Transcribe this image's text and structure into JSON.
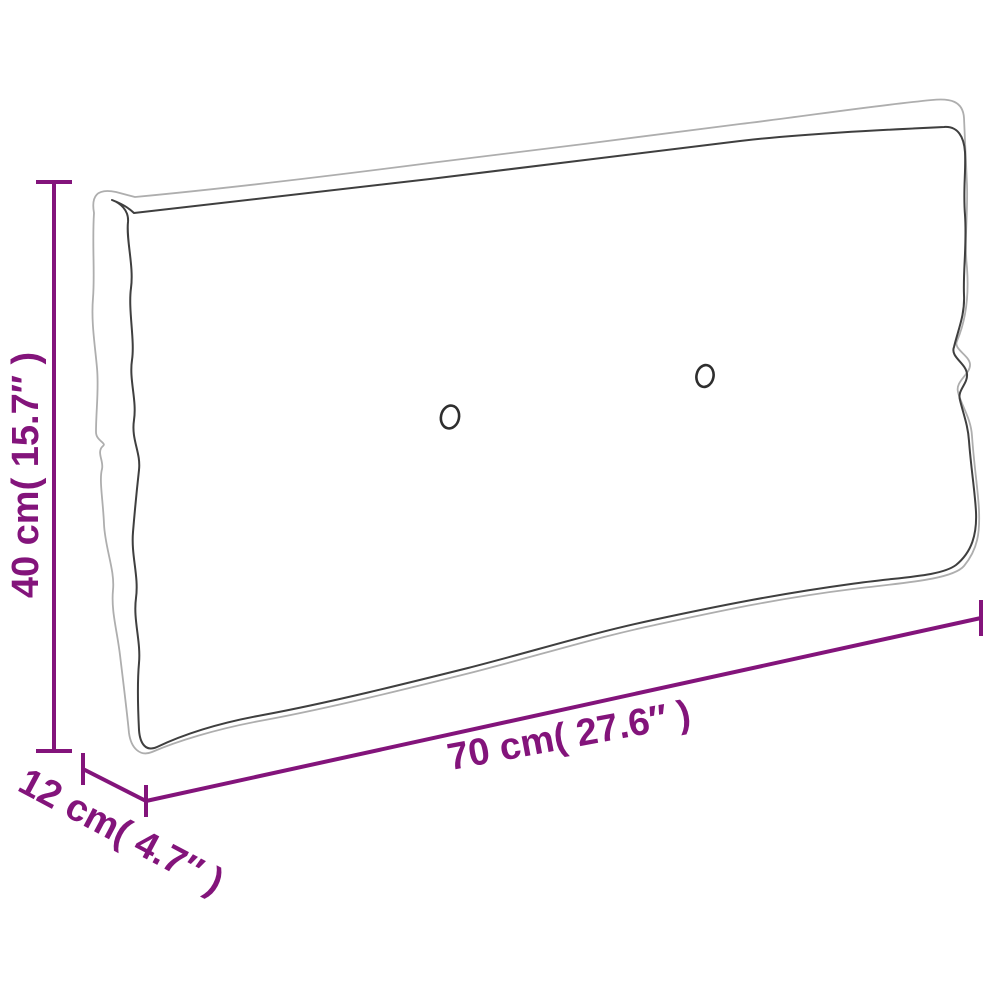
{
  "diagram": {
    "labels": {
      "height": "40 cm( 15.7″ )",
      "length": "70 cm( 27.6″ )",
      "depth": "12 cm( 4.7″ )"
    },
    "colors": {
      "dimension_accent": "#83147b",
      "outline_outer": "#aeaeae",
      "outline_seam": "#3f3f3f",
      "button": "#2e2e2e",
      "background": "#ffffff"
    }
  }
}
